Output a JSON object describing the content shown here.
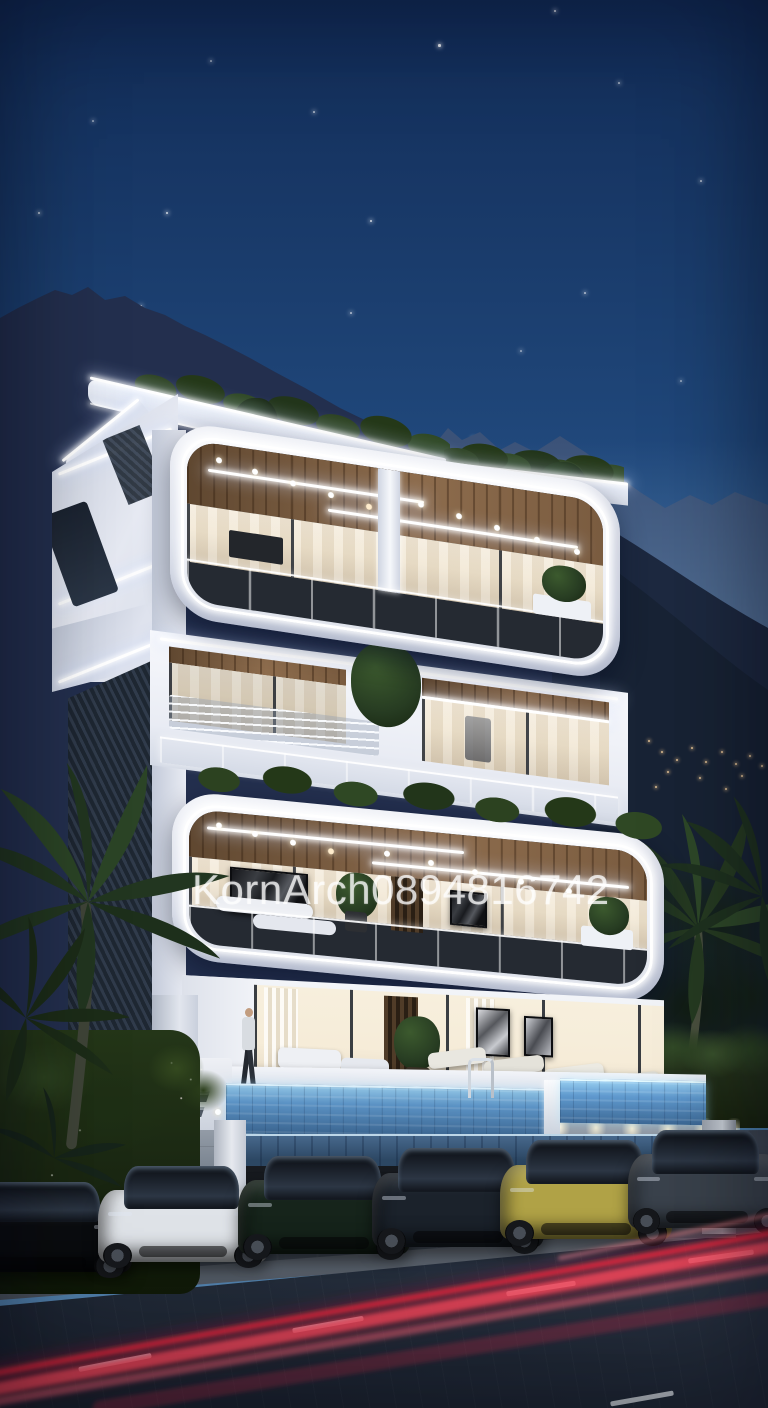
{
  "meta": {
    "kind": "architectural-render-photo",
    "time_of_day": "dusk-night",
    "description": "Modern multi-storey luxury villa with curved white LED-lit balconies, rooftop planting, infinity pool cantilevered above a parking bay with six supercars, palm trees, dusk mountain backdrop with stars, and red tail-light trails on the road in front."
  },
  "watermark": {
    "text": "KornArch0894816742",
    "color": "#ffffff",
    "opacity": 0.88
  },
  "palette": {
    "sky-top": "#122c57",
    "sky-mid": "#1f4679",
    "sky-low": "#33639a",
    "sky-horizon": "#4b7fae",
    "star": "#ffffff",
    "mtn-far": "#3b5278",
    "mtn-near": "#232f4e",
    "mtn-right": "#1d2940",
    "white": "#e9ecf4",
    "white-bright": "#f8f9fc",
    "led": "#ffffff",
    "wood": "#8d6c4d",
    "wood-dark": "#5f4730",
    "glass-warm": "#f0e5d0",
    "interior": "#f6ecd8",
    "mullion": "#343b44",
    "cladding": "#27313f",
    "pool": "#5b92c4",
    "pool-deep": "#3a648f",
    "deck": "#e3e7ee",
    "concrete": "#7b8591",
    "concrete-dark": "#58616d",
    "hedge": "#28361f",
    "foliage": "#152016",
    "palm": "#273c22",
    "garden": "#1a2712",
    "pavement": "#454e5b",
    "curb": "#636b76",
    "road": "#222b39",
    "trail": "#ff4458"
  },
  "scene": {
    "stars": [
      [
        472,
        438,
        3,
        1
      ],
      [
        438,
        44,
        2.5,
        0.9
      ],
      [
        554,
        10,
        2,
        0.8
      ],
      [
        166,
        212,
        2,
        0.8
      ],
      [
        38,
        212,
        2,
        0.7
      ],
      [
        140,
        305,
        2,
        0.7
      ],
      [
        370,
        220,
        2,
        0.8
      ],
      [
        350,
        312,
        1.5,
        0.6
      ],
      [
        313,
        111,
        1.5,
        0.6
      ],
      [
        265,
        424,
        2,
        0.7
      ],
      [
        476,
        519,
        2,
        0.8
      ],
      [
        584,
        292,
        1.5,
        0.6
      ],
      [
        700,
        180,
        1.5,
        0.6
      ],
      [
        618,
        82,
        1.5,
        0.55
      ],
      [
        92,
        120,
        1.5,
        0.5
      ],
      [
        520,
        350,
        1.5,
        0.5
      ],
      [
        210,
        60,
        1.5,
        0.5
      ],
      [
        680,
        380,
        1.5,
        0.5
      ]
    ],
    "village_lights": [
      [
        648,
        740
      ],
      [
        661,
        751
      ],
      [
        676,
        759
      ],
      [
        691,
        747
      ],
      [
        705,
        761
      ],
      [
        721,
        751
      ],
      [
        735,
        763
      ],
      [
        749,
        755
      ],
      [
        761,
        765
      ],
      [
        699,
        777
      ],
      [
        667,
        771
      ],
      [
        741,
        775
      ],
      [
        655,
        786
      ],
      [
        725,
        788
      ]
    ],
    "cars": [
      {
        "name": "car-black-cropped",
        "color": "#0b0d10",
        "x": -58,
        "y": 1178,
        "w": 190,
        "h": 100
      },
      {
        "name": "car-white",
        "color": "#dfe3e8",
        "x": 98,
        "y": 1162,
        "w": 170,
        "h": 106
      },
      {
        "name": "car-dark-green",
        "color": "#16241b",
        "x": 238,
        "y": 1152,
        "w": 172,
        "h": 108
      },
      {
        "name": "car-graphite",
        "color": "#1b222b",
        "x": 372,
        "y": 1144,
        "w": 172,
        "h": 110
      },
      {
        "name": "car-yellow",
        "color": "#b0a246",
        "x": 500,
        "y": 1136,
        "w": 172,
        "h": 110
      },
      {
        "name": "car-grey",
        "color": "#3a424c",
        "x": 628,
        "y": 1126,
        "w": 158,
        "h": 108
      }
    ],
    "lane_dashes": [
      {
        "x": 78,
        "y": 1360,
        "w": 74,
        "r": -11
      },
      {
        "x": 292,
        "y": 1322,
        "w": 72,
        "r": -10
      },
      {
        "x": 506,
        "y": 1286,
        "w": 70,
        "r": -9
      },
      {
        "x": 688,
        "y": 1254,
        "w": 66,
        "r": -8
      },
      {
        "x": 610,
        "y": 1396,
        "w": 64,
        "r": -10
      }
    ],
    "pool": {
      "sections": 2,
      "has_ladder": true
    },
    "figures": [
      {
        "name": "person-walking",
        "x": 240,
        "y": 1010
      }
    ]
  }
}
